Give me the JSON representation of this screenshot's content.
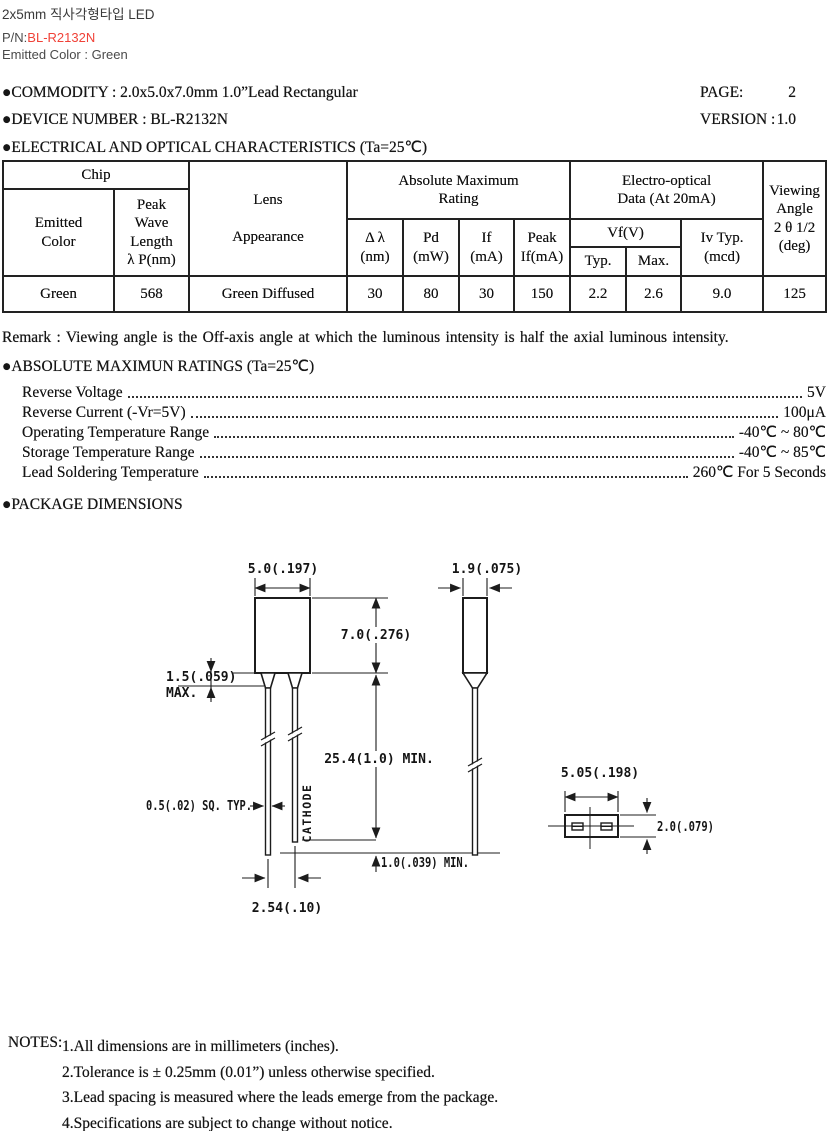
{
  "topbar": {
    "title": "2x5mm 직사각형타입 LED",
    "pn_label": "P/N:",
    "pn_value": "BL-R2132N",
    "emitted": "Emitted Color : Green"
  },
  "header": {
    "commodity": "●COMMODITY : 2.0x5.0x7.0mm 1.0”Lead Rectangular",
    "page_label": "PAGE:",
    "page_value": "2",
    "device": "●DEVICE NUMBER : BL-R2132N",
    "version_label": "VERSION :",
    "version_value": "1.0",
    "elec_title": "●ELECTRICAL AND OPTICAL CHARACTERISTICS (Ta=25℃)"
  },
  "table": {
    "headers": {
      "chip": "Chip",
      "emitted_color": "Emitted\nColor",
      "peak_wave": "Peak\nWave\nLength\nλ P(nm)",
      "lens": "Lens\n\nAppearance",
      "abs_max": "Absolute Maximum\nRating",
      "delta_lambda": "Δ λ\n(nm)",
      "pd": "Pd\n(mW)",
      "if": "If\n(mA)",
      "peak_if": "Peak\nIf(mA)",
      "electro": "Electro-optical\nData (At 20mA)",
      "vf": "Vf(V)",
      "vf_typ": "Typ.",
      "vf_max": "Max.",
      "iv": "Iv Typ.\n(mcd)",
      "viewing": "Viewing\nAngle\n2 θ 1/2\n(deg)"
    },
    "row": {
      "emitted_color": "Green",
      "peak_wave": "568",
      "lens": "Green Diffused",
      "delta_lambda": "30",
      "pd": "80",
      "if": "30",
      "peak_if": "150",
      "vf_typ": "2.2",
      "vf_max": "2.6",
      "iv": "9.0",
      "viewing": "125"
    }
  },
  "remark": "Remark : Viewing angle is the Off-axis angle at which the luminous intensity is half the axial luminous intensity.",
  "ratings": {
    "title": "●ABSOLUTE MAXIMUN RATINGS (Ta=25℃)",
    "items": [
      {
        "label": "Reverse Voltage",
        "value": "5V"
      },
      {
        "label": "Reverse Current (-Vr=5V)",
        "value": "100μA"
      },
      {
        "label": "Operating Temperature Range",
        "value": "-40℃ ~ 80℃"
      },
      {
        "label": "Storage Temperature Range",
        "value": "-40℃ ~ 85℃"
      },
      {
        "label": "Lead Soldering Temperature",
        "value": "260℃ For 5 Seconds"
      }
    ]
  },
  "package": {
    "title": "●PACKAGE DIMENSIONS",
    "dims": {
      "front_width": "5.0(.197)",
      "front_height": "7.0(.276)",
      "standoff": "1.5(.059)",
      "standoff_max": "MAX.",
      "lead_length": "25.4(1.0) MIN.",
      "lead_sq": "0.5(.02) SQ. TYP.",
      "cathode": "CATHODE",
      "lead_tip": "1.0(.039) MIN.",
      "lead_pitch": "2.54(.10)",
      "side_width": "1.9(.075)",
      "bottom_width": "5.05(.198)",
      "bottom_height": "2.0(.079)"
    }
  },
  "notes": {
    "label": "NOTES:",
    "items": [
      "1.All dimensions are in millimeters (inches).",
      "2.Tolerance is ± 0.25mm (0.01”) unless otherwise specified.",
      "3.Lead spacing is measured where the leads emerge from the package.",
      "4.Specifications are subject to change without notice."
    ]
  },
  "colors": {
    "accent_red": "#f04238",
    "ink": "#161616",
    "gray_text": "#4a4a4a",
    "table_border": "#222222"
  }
}
